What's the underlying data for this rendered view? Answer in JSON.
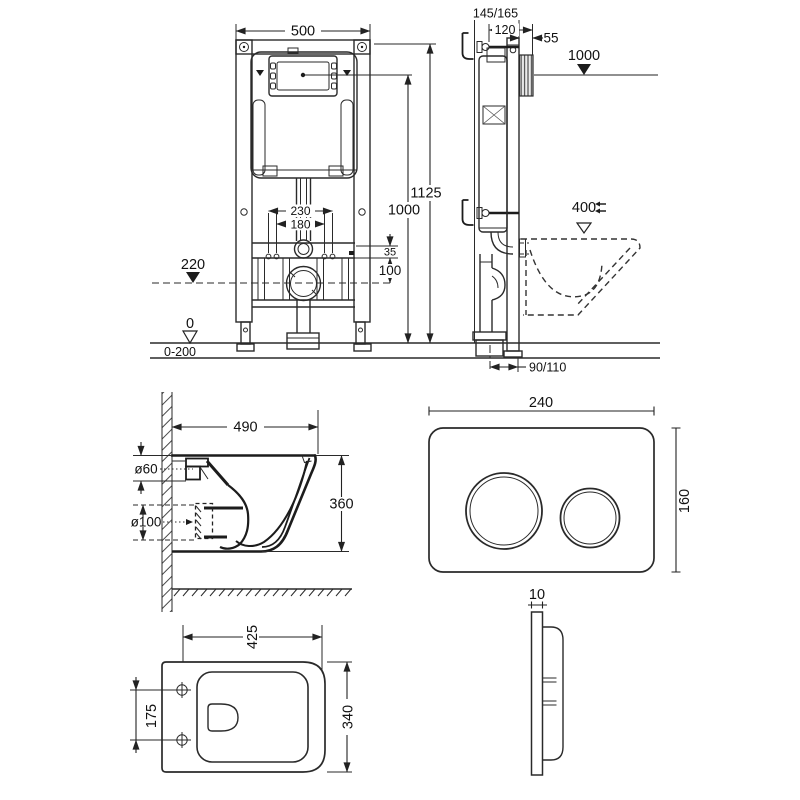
{
  "colors": {
    "background": "#ffffff",
    "line": "#2a2a2a",
    "text": "#111111"
  },
  "views": {
    "frame_front": {
      "width": "500",
      "total_height": "1125",
      "button_height": "1000",
      "bolt_span_outer": "230",
      "bolt_span_inner": "180",
      "bracket_offset": "35",
      "drain_offset": "100",
      "drain_level": "220",
      "floor_level": "0",
      "adjust_range": "0-200"
    },
    "frame_side": {
      "depth_range": "145/165",
      "frame_depth": "120",
      "front_offset": "55",
      "button_height": "1000",
      "bowl_top_height": "400",
      "outlet_offset": "90/110"
    },
    "bowl_side": {
      "depth": "490",
      "height": "360",
      "inlet_diameter": "ø60",
      "outlet_diameter": "ø100"
    },
    "plate_front": {
      "width": "240",
      "height": "160"
    },
    "bowl_top": {
      "width": "425",
      "length": "340",
      "bolt_spacing": "175"
    },
    "plate_side": {
      "thickness": "10"
    }
  }
}
